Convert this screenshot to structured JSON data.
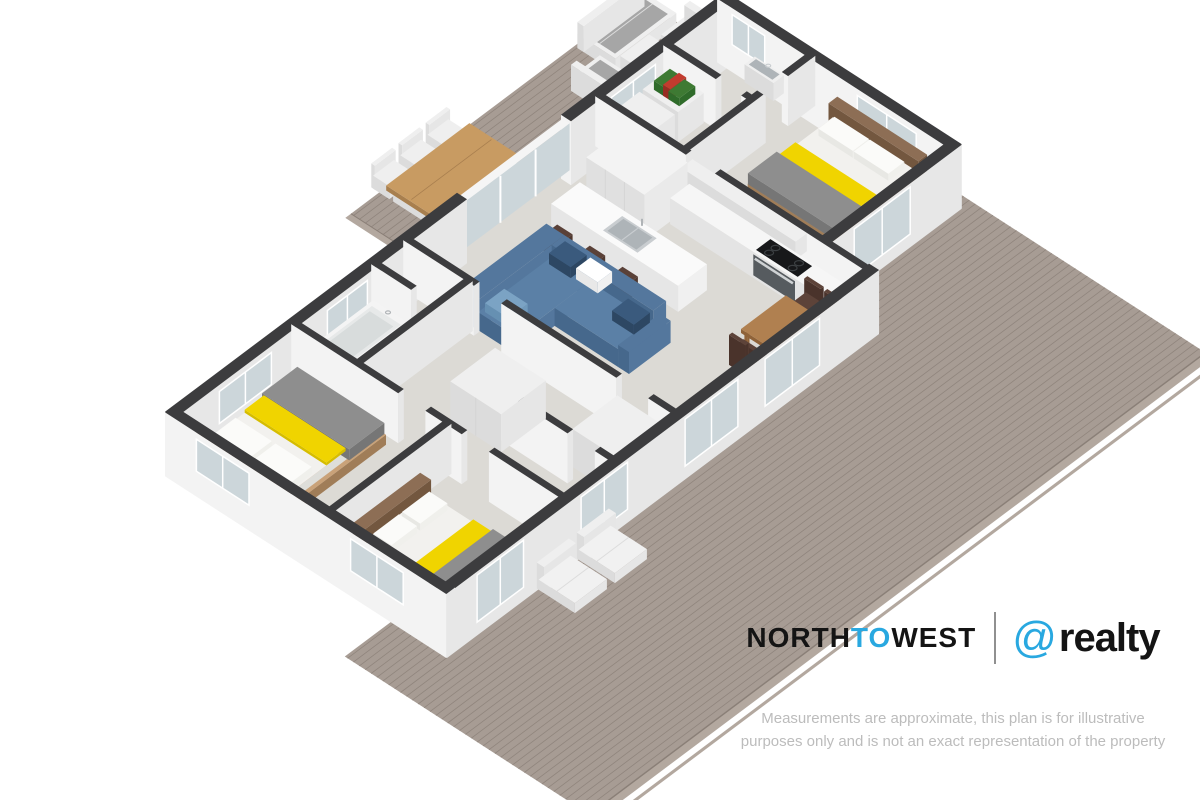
{
  "page": {
    "width": 1200,
    "height": 800,
    "background": "#ffffff"
  },
  "branding": {
    "logo": {
      "word1": "NORTH",
      "word2": "TO",
      "word3": "WEST",
      "at_symbol": "@",
      "word4": "realty",
      "accent": "#29a8e0",
      "ink": "#141414",
      "divider": "#909090"
    },
    "disclaimer": {
      "line1": "Measurements are approximate, this plan is for illustrative",
      "line2": "purposes only and is not an exact representation of the property",
      "color": "#bcbcbc"
    }
  },
  "floorplan": {
    "view": "3D isometric dollhouse floor plan, white cut walls, viewed from above at an angle",
    "rooms": [
      "open-plan living / kitchen / dining",
      "master bedroom",
      "bedroom 2",
      "bedroom 3",
      "bathroom with bathtub",
      "second bathroom / WC with wall basin",
      "laundry",
      "hallway with wardrobes",
      "covered outdoor dining deck",
      "rear wrap-around timber deck"
    ],
    "furniture": [
      "blue L-shaped corner sofa with patterned cushions",
      "white kitchen island with sink and 3 dark bar stools",
      "kitchen run with under-bench oven and black cooktop",
      "tall white pantry / fridge cabinets",
      "timber dining table with 4 dark timber chairs",
      "3 double beds with grey duvets, yellow runners and timber headboards",
      "white bathtub",
      "wall-hung basin",
      "white laundry cabinets with green and red items on top",
      "outdoor timber dining table with 6 white chairs",
      "outdoor lounge set with grey cushions and white coffee table",
      "2 white deck chairs on rear deck",
      "white wardrobe cabinets in hallway"
    ],
    "colors": {
      "deck_wood": "#a79c94",
      "deck_plank_line": "#90857d",
      "deck_fascia": "#b3a89f",
      "deck_edge": "#8a7f77",
      "shadow": "rgba(0,0,0,0.07)",
      "floor": "#dcdad5",
      "wall_top": "#3c3c3e",
      "wall_face": "#f3f3f3",
      "wall_face_dark": "#e7e7e7",
      "glass": "#ccd6da",
      "glass_frame": "#ffffff",
      "sofa_top": "#5b80a6",
      "sofa_mid": "#54779d",
      "sofa_side": "#46688c",
      "pillow_navy": "#3a5a7d",
      "pillow_navy_dark": "#2d4763",
      "pillow_light": "#7ba3c4",
      "yellow": "#f0d400",
      "yellow_dark": "#d6bd00",
      "duvet": "#8e8e8e",
      "duvet_dark": "#767676",
      "mattress": "#f2f1ee",
      "mattress_side": "#dededa",
      "bedframe": "#c9a279",
      "bedframe_dark": "#a07d58",
      "headboard": "#8d6e55",
      "headboard_dark": "#73573f",
      "white_furn": "#efefef",
      "white_furn_side": "#dcdcdc",
      "white_furn_mid": "#e6e6e6",
      "island_top": "#fafafa",
      "cooktop": "#17181a",
      "cooktop_ring": "#3c4043",
      "oven": "#565b5f",
      "sink": "#c9cdd0",
      "sink_inner": "#aeb4b8",
      "stool": "#5a4138",
      "stool_side": "#452f28",
      "stool_mid": "#4f382f",
      "table_wood": "#b08050",
      "table_wood_dark": "#8f6238",
      "table_wood_mid": "#9e7044",
      "chair_wood": "#5d4339",
      "chair_wood_dark": "#4a332b",
      "outdoor_table": "#c89b62",
      "outdoor_table_dark": "#a87f4e",
      "outdoor_cushion": "#a6a6a6",
      "tub_inner": "#e7e9e9",
      "green_obj": "#3e7a33",
      "green_obj2": "#2f6b2a",
      "red_obj": "#c23b2e"
    }
  }
}
